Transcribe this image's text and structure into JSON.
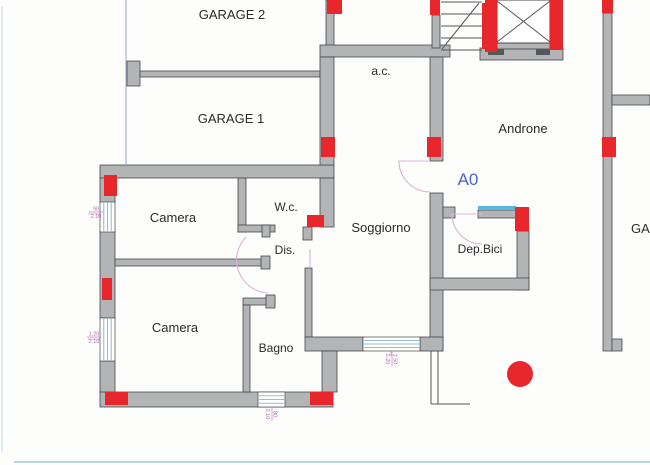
{
  "plan": {
    "width": 650,
    "height": 465,
    "colors": {
      "paper": "#fdfdfc",
      "wall_fill": "#b2b4b6",
      "wall_stroke": "#46484b",
      "red": "#e8272c",
      "window_line": "#9bbdd8",
      "cyan": "#55bade",
      "door_arc": "#dcb3d2",
      "dim_text": "#b66ab0",
      "label": "#2b2b2b",
      "unit_blue": "#4a63c8",
      "guide_blue": "#8fa9cc",
      "scan_line": "#a8c6de",
      "scan_line_light": "#ccdcec",
      "thin": "#55585a",
      "shaft_fill": "#ffffff",
      "notch": "#55585a"
    },
    "labels": [
      {
        "n": "label-garage2",
        "t": "GARAGE 2",
        "x": 232,
        "y": 19,
        "s": 13
      },
      {
        "n": "label-garage1",
        "t": "GARAGE 1",
        "x": 231,
        "y": 123,
        "s": 13
      },
      {
        "n": "label-androne",
        "t": "Androne",
        "x": 523,
        "y": 133,
        "s": 13
      },
      {
        "n": "label-ac",
        "t": "a.c.",
        "x": 381,
        "y": 75,
        "s": 12
      },
      {
        "n": "label-wc",
        "t": "W.c.",
        "x": 286,
        "y": 211,
        "s": 12
      },
      {
        "n": "label-camera-1",
        "t": "Camera",
        "x": 173,
        "y": 222,
        "s": 13
      },
      {
        "n": "label-soggiorno",
        "t": "Soggiorno",
        "x": 381,
        "y": 232,
        "s": 13
      },
      {
        "n": "label-dis",
        "t": "Dis.",
        "x": 285,
        "y": 254,
        "s": 12
      },
      {
        "n": "label-depbici",
        "t": "Dep.Bici",
        "x": 480,
        "y": 253,
        "s": 12
      },
      {
        "n": "label-camera-2",
        "t": "Camera",
        "x": 175,
        "y": 332,
        "s": 13
      },
      {
        "n": "label-bagno",
        "t": "Bagno",
        "x": 276,
        "y": 352,
        "s": 12
      },
      {
        "n": "label-unit-a0",
        "t": "A0",
        "x": 468,
        "y": 185,
        "s": 17,
        "c": "unit_blue"
      },
      {
        "n": "label-garage-right",
        "t": "GAR",
        "x": 631,
        "y": 233,
        "s": 13,
        "a": "start"
      }
    ],
    "dims": [
      {
        "n": "dim-left-upper-window",
        "x": 96,
        "y": 212,
        "a": "90",
        "b": "2.10",
        "rot": 0
      },
      {
        "n": "dim-left-lower-window",
        "x": 94,
        "y": 337,
        "a": "1.20",
        "b": "2.10",
        "rot": 0
      },
      {
        "n": "dim-bagno-window",
        "x": 272,
        "y": 414,
        "a": "80",
        "b": "2.10",
        "rot": 90
      },
      {
        "n": "dim-soggiorno-window",
        "x": 392,
        "y": 359,
        "a": "1.50",
        "b": "2.20",
        "rot": 90
      }
    ],
    "walls": [
      {
        "n": "garage-pillar",
        "x": 127,
        "y": 61,
        "w": 13,
        "h": 25
      },
      {
        "n": "garage-divider-wall",
        "x": 140,
        "y": 71,
        "w": 180,
        "h": 6
      },
      {
        "n": "main-top-wall",
        "x": 100,
        "y": 165,
        "w": 234,
        "h": 13
      },
      {
        "n": "left-wall-upper",
        "x": 100,
        "y": 178,
        "w": 15,
        "h": 25
      },
      {
        "n": "left-wall-mid",
        "x": 100,
        "y": 231,
        "w": 15,
        "h": 87
      },
      {
        "n": "left-wall-lower",
        "x": 100,
        "y": 361,
        "w": 15,
        "h": 32
      },
      {
        "n": "bottom-wall",
        "x": 100,
        "y": 392,
        "w": 233,
        "h": 15
      },
      {
        "n": "ac-wall-upper",
        "x": 326,
        "y": 0,
        "w": 8,
        "h": 46
      },
      {
        "n": "ac-top-wall",
        "x": 320,
        "y": 45,
        "w": 130,
        "h": 12
      },
      {
        "n": "ac-left-wall",
        "x": 320,
        "y": 57,
        "w": 14,
        "h": 108
      },
      {
        "n": "wc-right-wall",
        "x": 320,
        "y": 178,
        "w": 14,
        "h": 49
      },
      {
        "n": "ac-right-wall",
        "x": 430,
        "y": 57,
        "w": 13,
        "h": 104
      },
      {
        "n": "stair-left-wall",
        "x": 432,
        "y": 15,
        "w": 8,
        "h": 33
      },
      {
        "n": "soggiorno-right-wall",
        "x": 430,
        "y": 193,
        "w": 13,
        "h": 158
      },
      {
        "n": "depbici-door-stub",
        "x": 443,
        "y": 207,
        "w": 12,
        "h": 11
      },
      {
        "n": "depbici-window-sill",
        "x": 478,
        "y": 210,
        "w": 38,
        "h": 8
      },
      {
        "n": "depbici-right-wall",
        "x": 517,
        "y": 231,
        "w": 12,
        "h": 59
      },
      {
        "n": "depbici-bottom-wall",
        "x": 430,
        "y": 278,
        "w": 99,
        "h": 12
      },
      {
        "n": "wc-left-wall",
        "x": 238,
        "y": 178,
        "w": 8,
        "h": 54
      },
      {
        "n": "wc-bottom-wall",
        "x": 238,
        "y": 225,
        "w": 37,
        "h": 7
      },
      {
        "n": "wc-bottom-cap",
        "x": 262,
        "y": 225,
        "w": 8,
        "h": 12
      },
      {
        "n": "camera-divider-wall",
        "x": 115,
        "y": 259,
        "w": 147,
        "h": 7
      },
      {
        "n": "camera-divider-cap",
        "x": 261,
        "y": 256,
        "w": 9,
        "h": 13
      },
      {
        "n": "soggiorno-notch",
        "x": 303,
        "y": 227,
        "w": 9,
        "h": 13
      },
      {
        "n": "soggiorno-left-thin-wall",
        "x": 305,
        "y": 268,
        "w": 7,
        "h": 69
      },
      {
        "n": "soggiorno-bottom-wall",
        "x": 305,
        "y": 337,
        "w": 58,
        "h": 14
      },
      {
        "n": "soggiorno-bottom-corner",
        "x": 420,
        "y": 337,
        "w": 23,
        "h": 14
      },
      {
        "n": "terrace-wall",
        "x": 322,
        "y": 351,
        "w": 15,
        "h": 41
      },
      {
        "n": "bagno-top-stub",
        "x": 243,
        "y": 298,
        "w": 32,
        "h": 7
      },
      {
        "n": "bagno-top-cap",
        "x": 266,
        "y": 295,
        "w": 9,
        "h": 13
      },
      {
        "n": "bagno-left-wall",
        "x": 243,
        "y": 305,
        "w": 7,
        "h": 87
      },
      {
        "n": "right-outer-wall",
        "x": 603,
        "y": 13,
        "w": 9,
        "h": 338
      },
      {
        "n": "right-wall-foot",
        "x": 612,
        "y": 339,
        "w": 10,
        "h": 12
      },
      {
        "n": "right-branch-wall",
        "x": 612,
        "y": 95,
        "w": 38,
        "h": 10
      },
      {
        "n": "elevator-base",
        "x": 480,
        "y": 48,
        "w": 83,
        "h": 12
      },
      {
        "n": "elevator-door",
        "x": 497,
        "y": 41,
        "w": 53,
        "h": 8
      }
    ],
    "white_rects": [
      {
        "n": "elevator-shaft",
        "x": 497,
        "y": 0,
        "w": 53,
        "h": 43
      }
    ],
    "dark_rects": [
      {
        "n": "elevator-notch-left",
        "x": 488,
        "y": 49,
        "w": 16,
        "h": 6
      },
      {
        "n": "elevator-notch-right",
        "x": 536,
        "y": 49,
        "w": 14,
        "h": 6
      }
    ],
    "cyan_rects": [
      {
        "n": "depbici-window-glass",
        "x": 478,
        "y": 206,
        "w": 38,
        "h": 4
      }
    ],
    "red_markers": [
      {
        "n": "marker-ac-top",
        "x": 327,
        "y": 0,
        "w": 15,
        "h": 14
      },
      {
        "n": "marker-stair-wall-top",
        "x": 430,
        "y": 0,
        "w": 10,
        "h": 15
      },
      {
        "n": "marker-stair-bar",
        "x": 482,
        "y": 3,
        "w": 10,
        "h": 46
      },
      {
        "n": "marker-elevator-left",
        "x": 485,
        "y": 0,
        "w": 12,
        "h": 52
      },
      {
        "n": "marker-elevator-right",
        "x": 550,
        "y": 0,
        "w": 13,
        "h": 50
      },
      {
        "n": "marker-right-wall-top",
        "x": 602,
        "y": 0,
        "w": 11,
        "h": 13
      },
      {
        "n": "marker-right-wall-mid",
        "x": 602,
        "y": 137,
        "w": 14,
        "h": 20
      },
      {
        "n": "marker-ac-left",
        "x": 321,
        "y": 137,
        "w": 14,
        "h": 20
      },
      {
        "n": "marker-ac-right",
        "x": 427,
        "y": 137,
        "w": 14,
        "h": 20
      },
      {
        "n": "marker-left-wall-upper",
        "x": 104,
        "y": 175,
        "w": 13,
        "h": 21
      },
      {
        "n": "marker-left-wall-mid",
        "x": 102,
        "y": 278,
        "w": 10,
        "h": 22
      },
      {
        "n": "marker-wc-corner",
        "x": 307,
        "y": 215,
        "w": 17,
        "h": 12
      },
      {
        "n": "marker-bottom-left",
        "x": 105,
        "y": 392,
        "w": 23,
        "h": 13
      },
      {
        "n": "marker-bottom-mid",
        "x": 310,
        "y": 392,
        "w": 23,
        "h": 13
      },
      {
        "n": "marker-depbici",
        "x": 515,
        "y": 207,
        "w": 14,
        "h": 24
      }
    ],
    "red_dot": {
      "n": "red-dot",
      "cx": 520,
      "cy": 374,
      "r": 13
    },
    "windows": [
      {
        "n": "left-window-upper",
        "x": 100,
        "y": 202,
        "w": 15,
        "h": 30,
        "dir": "v"
      },
      {
        "n": "left-window-lower",
        "x": 100,
        "y": 318,
        "w": 15,
        "h": 43,
        "dir": "v"
      },
      {
        "n": "bagno-window",
        "x": 258,
        "y": 392,
        "w": 27,
        "h": 15,
        "dir": "h"
      },
      {
        "n": "soggiorno-window",
        "x": 363,
        "y": 337,
        "w": 57,
        "h": 14,
        "dir": "h"
      }
    ],
    "doors": [
      {
        "n": "door-a0-entrance",
        "d": "M 430 161 L 399 161 A 31 31 0 0 0 430 192"
      },
      {
        "n": "door-dis",
        "d": "M 246 237 A 33 33 0 0 0 268 293"
      },
      {
        "n": "door-soggiorno-leaf",
        "d": "M 310 249 L 310 268"
      },
      {
        "n": "door-depbici",
        "d": "M 482 214 L 452 214 A 30 30 0 0 0 482 244"
      }
    ],
    "lines": [
      {
        "n": "stair-tread",
        "x1": 441,
        "y1": 2,
        "x2": 482,
        "y2": 2,
        "c": "thin"
      },
      {
        "n": "stair-tread",
        "x1": 441,
        "y1": 14,
        "x2": 482,
        "y2": 14,
        "c": "thin"
      },
      {
        "n": "stair-tread",
        "x1": 441,
        "y1": 26,
        "x2": 482,
        "y2": 26,
        "c": "thin"
      },
      {
        "n": "stair-tread",
        "x1": 441,
        "y1": 38,
        "x2": 482,
        "y2": 38,
        "c": "thin"
      },
      {
        "n": "stair-tread",
        "x1": 441,
        "y1": 50,
        "x2": 482,
        "y2": 50,
        "c": "thin"
      },
      {
        "n": "stair-diagonal",
        "x1": 442,
        "y1": 49,
        "x2": 479,
        "y2": 3,
        "c": "thin"
      },
      {
        "n": "elevator-cross",
        "x1": 497,
        "y1": 1,
        "x2": 550,
        "y2": 42,
        "c": "thin"
      },
      {
        "n": "elevator-cross",
        "x1": 550,
        "y1": 1,
        "x2": 497,
        "y2": 42,
        "c": "thin"
      },
      {
        "n": "terrace-line",
        "x1": 431,
        "y1": 351,
        "x2": 431,
        "y2": 404,
        "c": "thin"
      },
      {
        "n": "terrace-line",
        "x1": 438,
        "y1": 351,
        "x2": 438,
        "y2": 404,
        "c": "thin"
      },
      {
        "n": "terrace-line",
        "x1": 431,
        "y1": 404,
        "x2": 470,
        "y2": 404,
        "c": "thin"
      },
      {
        "n": "guide-line",
        "x1": 126,
        "y1": 0,
        "x2": 126,
        "y2": 165,
        "c": "blue"
      },
      {
        "n": "dim-tick",
        "x1": 88,
        "y1": 214,
        "x2": 114,
        "y2": 214,
        "c": "tick"
      },
      {
        "n": "dim-tick",
        "x1": 88,
        "y1": 339,
        "x2": 114,
        "y2": 339,
        "c": "tick"
      },
      {
        "n": "dim-tick",
        "x1": 271,
        "y1": 393,
        "x2": 271,
        "y2": 407,
        "c": "tick"
      },
      {
        "n": "dim-tick",
        "x1": 391,
        "y1": 338,
        "x2": 391,
        "y2": 356,
        "c": "tick"
      },
      {
        "n": "scan-artifact-bottom",
        "x1": 14,
        "y1": 462,
        "x2": 650,
        "y2": 462,
        "c": "scan"
      },
      {
        "n": "scan-artifact-left",
        "x1": 2,
        "y1": 6,
        "x2": 2,
        "y2": 452,
        "c": "scan2"
      }
    ]
  }
}
